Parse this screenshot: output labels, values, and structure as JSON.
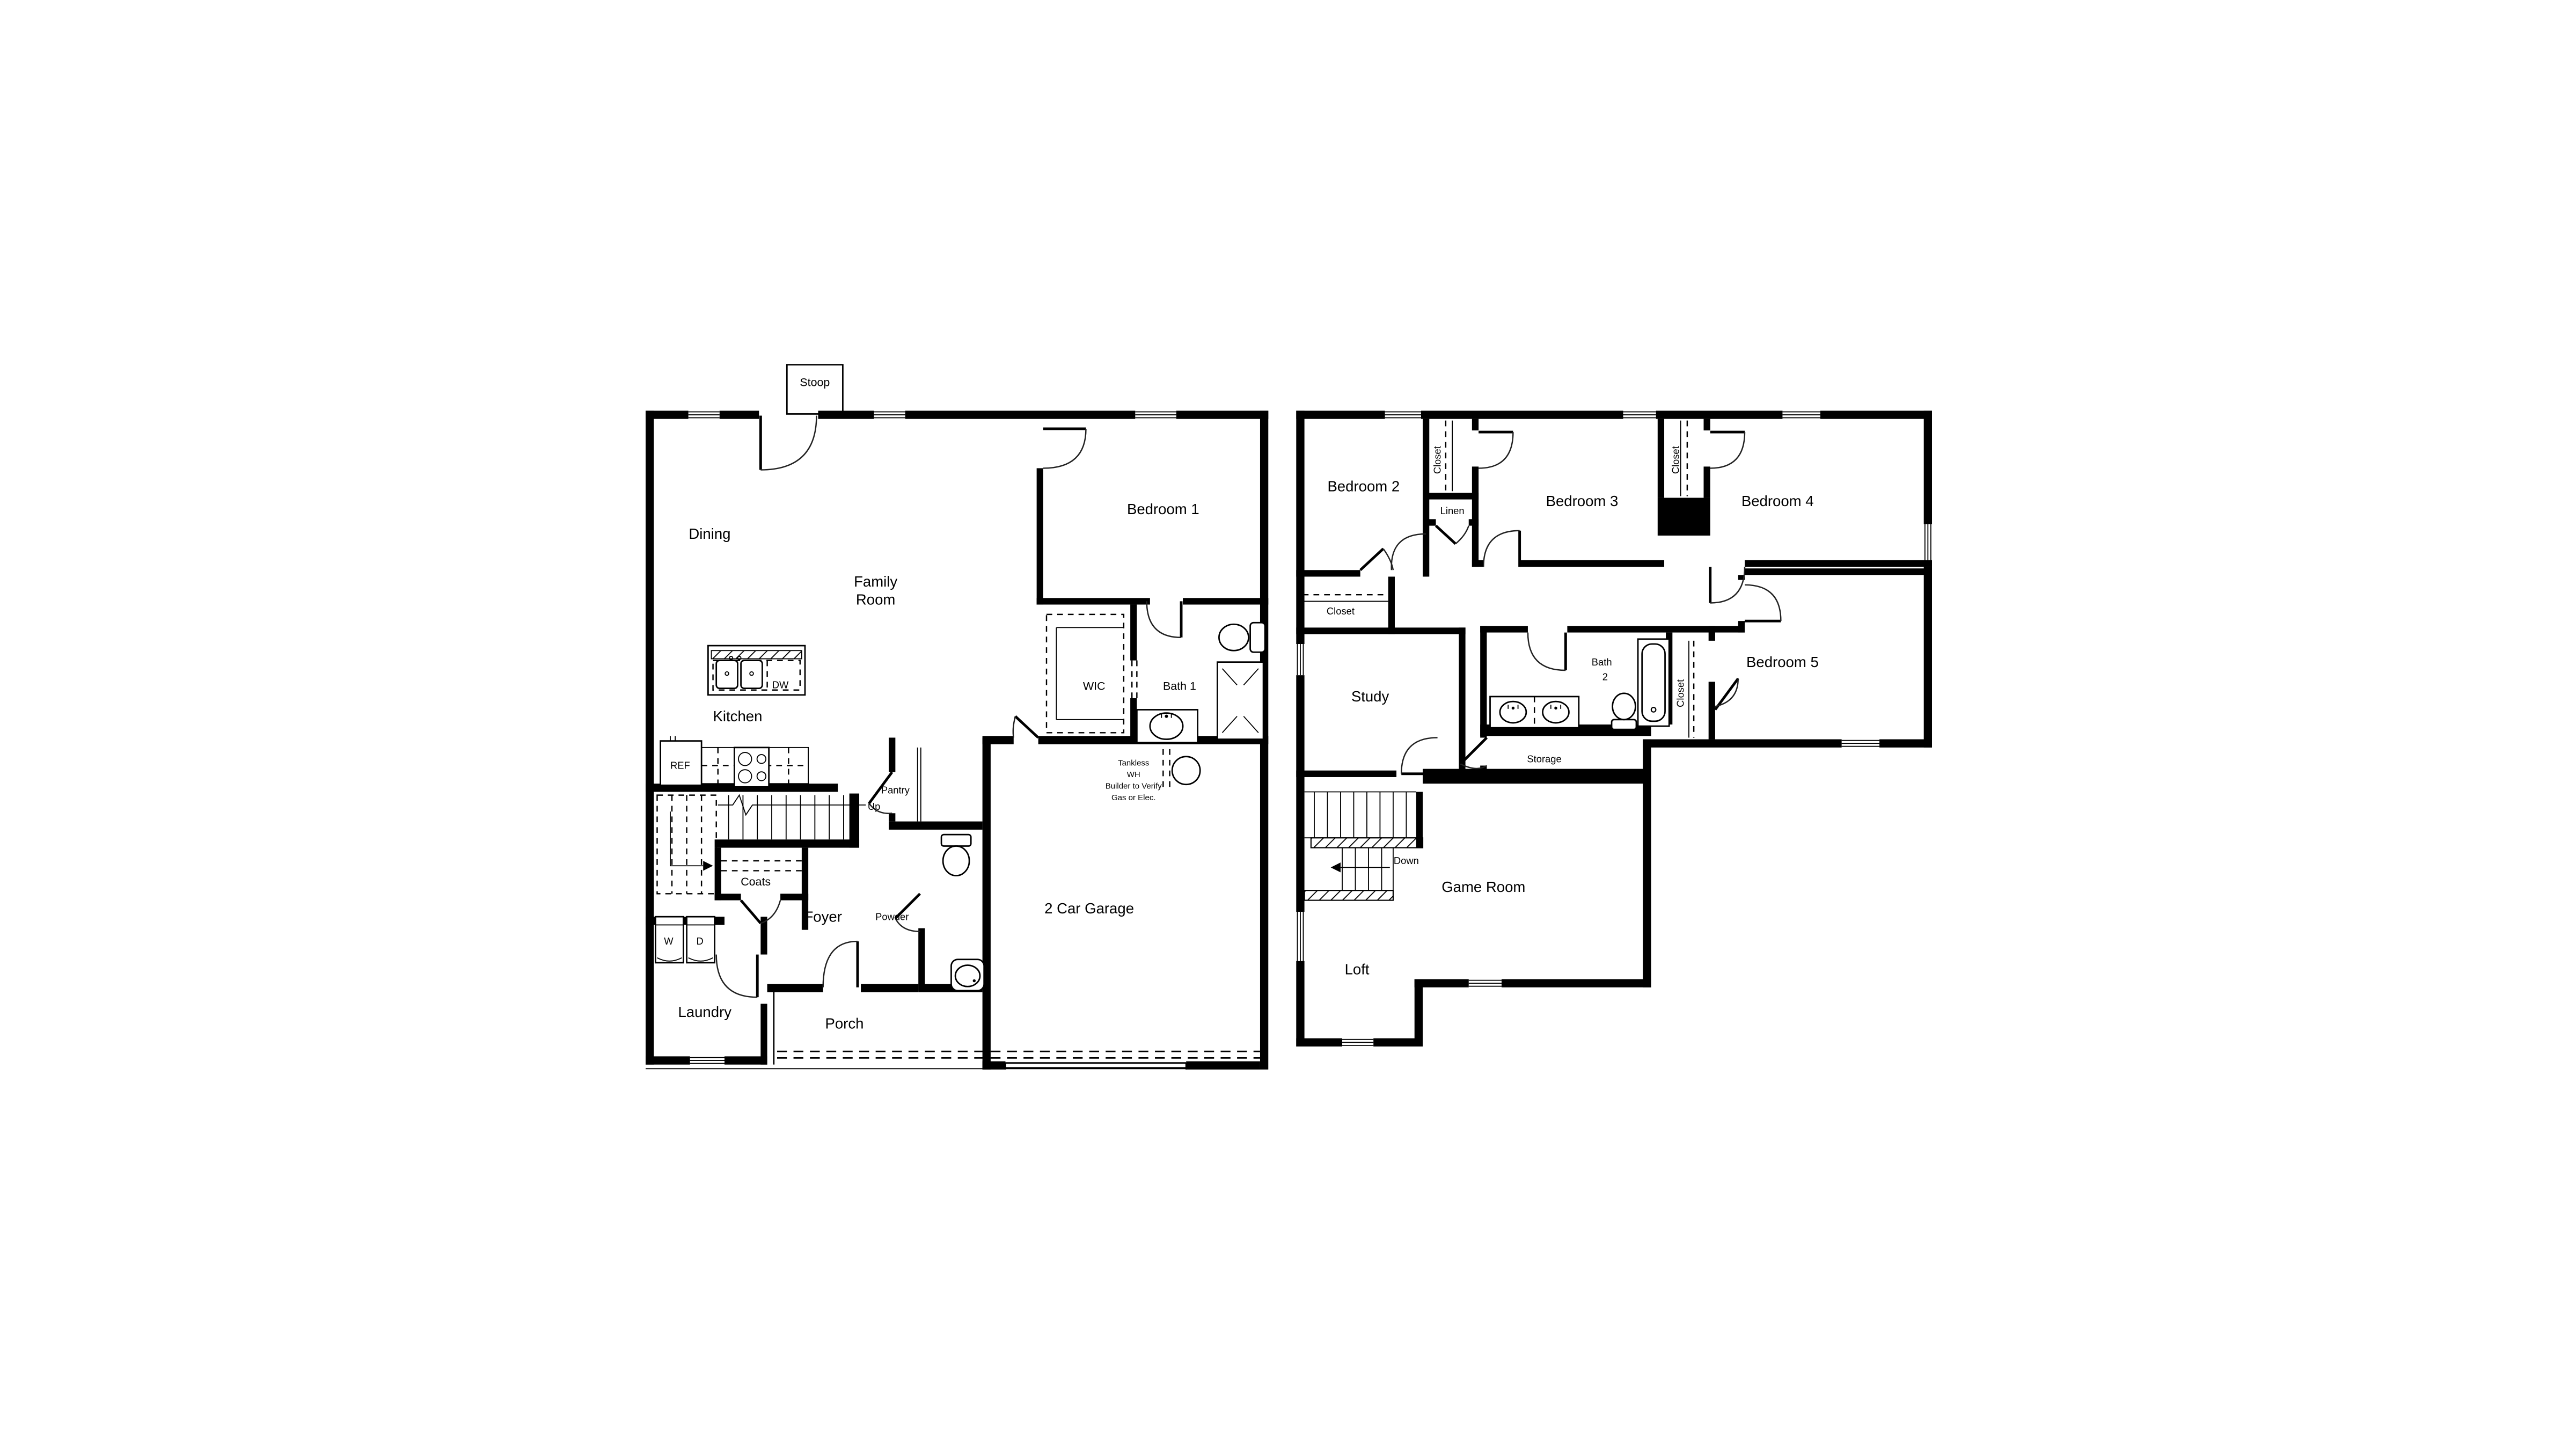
{
  "colors": {
    "walls": "#000000",
    "background": "#ffffff",
    "text": "#000000"
  },
  "floor1": {
    "stoop": "Stoop",
    "dining": "Dining",
    "family_line1": "Family",
    "family_line2": "Room",
    "bedroom1": "Bedroom 1",
    "wic": "WIC",
    "bath1": "Bath 1",
    "kitchen": "Kitchen",
    "dw": "DW",
    "ref": "REF",
    "up": "Up",
    "pantry": "Pantry",
    "coats": "Coats",
    "washer": "W",
    "dryer": "D",
    "laundry": "Laundry",
    "foyer": "Foyer",
    "powder": "Powder",
    "porch": "Porch",
    "garage": "2 Car Garage",
    "wh_line1": "Tankless",
    "wh_line2": "WH",
    "wh_line3": "Builder to Verify",
    "wh_line4": "Gas or Elec."
  },
  "floor2": {
    "bedroom2": "Bedroom 2",
    "closet_bed3": "Closet",
    "linen": "Linen",
    "bedroom3": "Bedroom 3",
    "closet_bed4": "Closet",
    "bedroom4": "Bedroom 4",
    "closet_bed2": "Closet",
    "study": "Study",
    "bath2_line1": "Bath",
    "bath2_line2": "2",
    "storage": "Storage",
    "closet_bed5": "Closet",
    "bedroom5": "Bedroom 5",
    "down": "Down",
    "game_room": "Game Room",
    "loft": "Loft"
  }
}
